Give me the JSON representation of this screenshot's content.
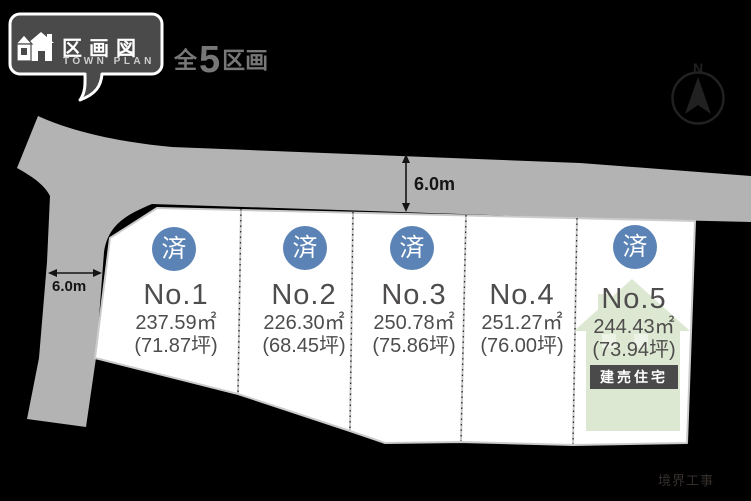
{
  "header": {
    "badge": {
      "title": "区画図",
      "subtitle": "TOWN PLAN"
    },
    "total_lots": {
      "prefix": "全",
      "count": "5",
      "suffix": "区画"
    }
  },
  "compass": {
    "label": "N"
  },
  "dimensions": {
    "road_top_width": "6.0m",
    "road_left_width": "6.0m"
  },
  "lots": [
    {
      "number": "No.1",
      "area_sqm": "237.59㎡",
      "area_tsubo": "(71.87坪)",
      "status": "済"
    },
    {
      "number": "No.2",
      "area_sqm": "226.30㎡",
      "area_tsubo": "(68.45坪)",
      "status": "済"
    },
    {
      "number": "No.3",
      "area_sqm": "250.78㎡",
      "area_tsubo": "(75.86坪)",
      "status": "済"
    },
    {
      "number": "No.4",
      "area_sqm": "251.27㎡",
      "area_tsubo": "(76.00坪)",
      "status": ""
    },
    {
      "number": "No.5",
      "area_sqm": "244.43㎡",
      "area_tsubo": "(73.94坪)",
      "status": "済",
      "tag": "建売住宅"
    }
  ],
  "footer": {
    "note": "境界工事"
  },
  "colors": {
    "background": "#000000",
    "road": "#b3b3b3",
    "lot_fill": "#ffffff",
    "sold_badge": "#5b83b5",
    "house_silhouette": "#dce8d1",
    "tag_bg": "#4a4a4a",
    "text": "#4e4c4c"
  }
}
